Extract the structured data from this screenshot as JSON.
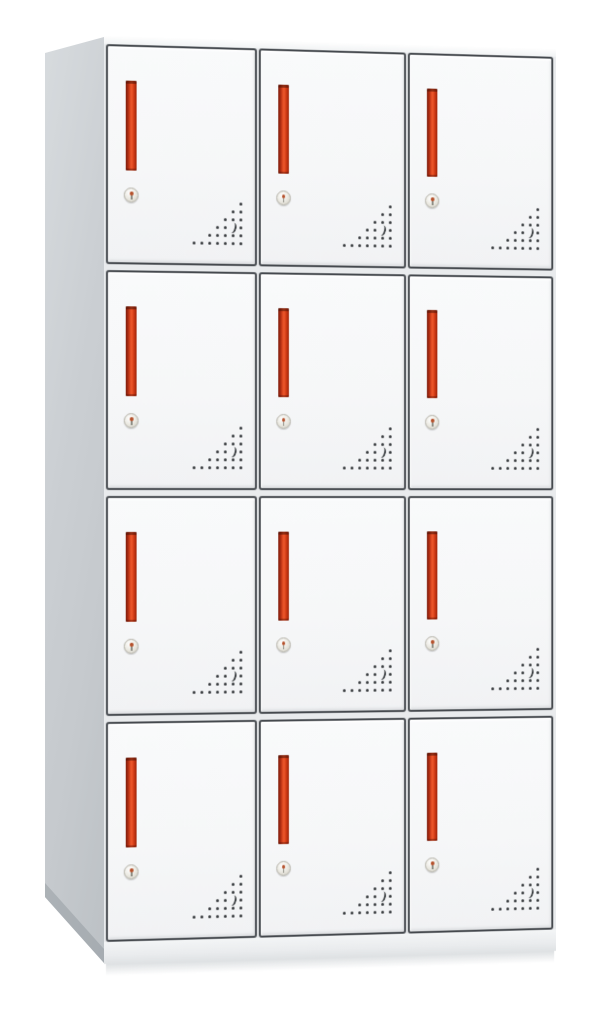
{
  "photo": {
    "subject": "White steel 12-compartment locker cabinet with red handles",
    "background_color": "#ffffff"
  },
  "cabinet": {
    "rows": 4,
    "columns": 3,
    "compartments": 12,
    "colors": {
      "door_face": "#f6f7f8",
      "door_border": "#45494e",
      "body_gap": "#e9ebed",
      "handle_red": "#e04a22",
      "handle_red_dark": "#8c2310",
      "side_panel": "#c9cdd1",
      "side_panel_shade": "#a9afb3",
      "top_edge": "#f7f8f9",
      "base": "#eceef0",
      "vent_dot": "#34383b",
      "lock_body": "#e9e7df",
      "lock_keyhole": "#b4502a"
    },
    "door_features": {
      "handle": "recessed vertical red pull handle",
      "lock": "round cam lock with keyhole",
      "vents": "triangular perforation pattern with crescent cutout"
    },
    "vent_pattern": {
      "cell_px": 8,
      "rows": [
        [
          6
        ],
        [
          5,
          6
        ],
        [
          4,
          5,
          6
        ],
        [
          3,
          4,
          6
        ],
        [
          2,
          3,
          4,
          5,
          6
        ],
        [
          0,
          1,
          2,
          3,
          4,
          5,
          6
        ]
      ],
      "crescent": {
        "row": 3,
        "col": 5
      }
    }
  }
}
